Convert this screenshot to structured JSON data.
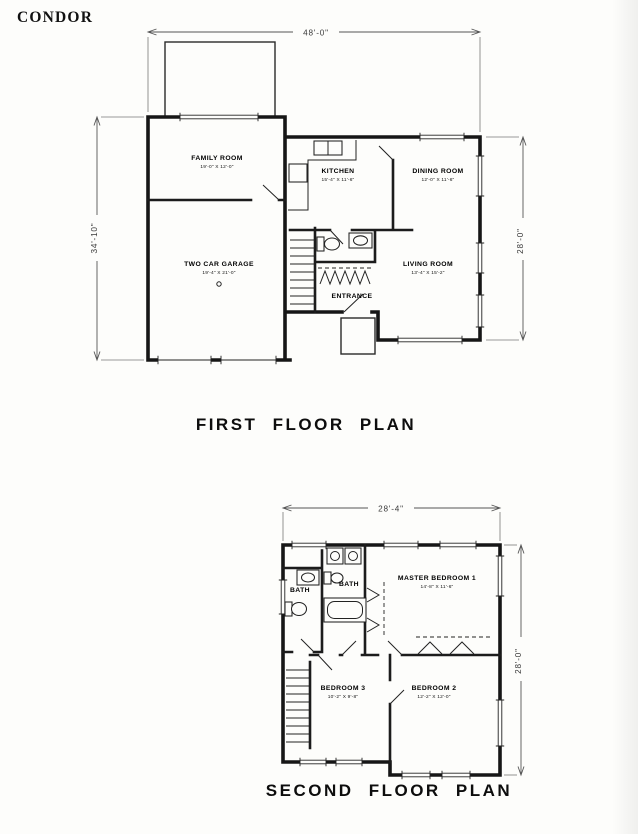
{
  "page": {
    "brand": "CONDOR"
  },
  "first_floor": {
    "caption": "FIRST FLOOR PLAN",
    "dim_width": "48'-0\"",
    "dim_left": "34'-10\"",
    "dim_right": "28'-0\"",
    "rooms": [
      {
        "name": "FAMILY ROOM",
        "size": "19'-0\" X 12'-0\""
      },
      {
        "name": "KITCHEN",
        "size": "15'-4\" X 11'-6\""
      },
      {
        "name": "DINING ROOM",
        "size": "12'-0\" X 11'-6\""
      },
      {
        "name": "TWO CAR GARAGE",
        "size": "19'-4\" X 21'-0\""
      },
      {
        "name": "LIVING ROOM",
        "size": "13'-4\" X 15'-2\""
      },
      {
        "name": "ENTRANCE",
        "size": ""
      }
    ]
  },
  "second_floor": {
    "caption": "SECOND FLOOR PLAN",
    "dim_width": "28'-4\"",
    "dim_right": "28'-0\"",
    "rooms": [
      {
        "name": "BATH",
        "size": ""
      },
      {
        "name": "BATH",
        "size": ""
      },
      {
        "name": "MASTER BEDROOM 1",
        "size": "14'-8\" X 11'-6\""
      },
      {
        "name": "BEDROOM 3",
        "size": "10'-2\" X 9'-8\""
      },
      {
        "name": "BEDROOM 2",
        "size": "12'-2\" X 12'-0\""
      }
    ]
  }
}
